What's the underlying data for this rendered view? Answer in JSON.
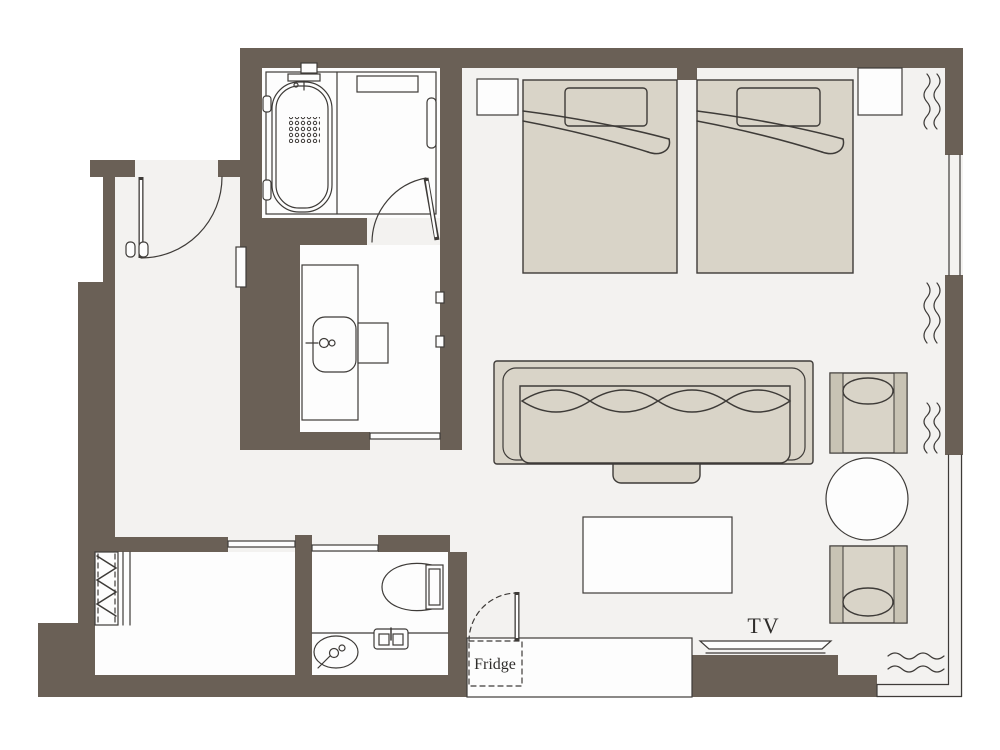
{
  "labels": {
    "tv": "TV",
    "fridge": "Fridge"
  },
  "colors": {
    "background": "#ffffff",
    "floor": "#f3f2f0",
    "room": "#fdfdfd",
    "wall": "#6a6056",
    "furniture": "#d9d4c8",
    "furniture_shade": "#c8c3b4",
    "line": "#3e3b38",
    "text": "#2f2d2b"
  },
  "fixtures": [
    "bed-1",
    "bed-2",
    "nightstand-1",
    "nightstand-2",
    "sofa",
    "ottoman",
    "coffee-table",
    "armchair-1",
    "armchair-2",
    "round-table",
    "tv",
    "tv-counter",
    "fridge",
    "bathtub",
    "vanity-sink",
    "stool",
    "toilet",
    "hand-basin",
    "paper-holder",
    "closet-hanger",
    "entry-door",
    "bathroom-door",
    "window",
    "balcony-railing",
    "curtain-symbols"
  ]
}
